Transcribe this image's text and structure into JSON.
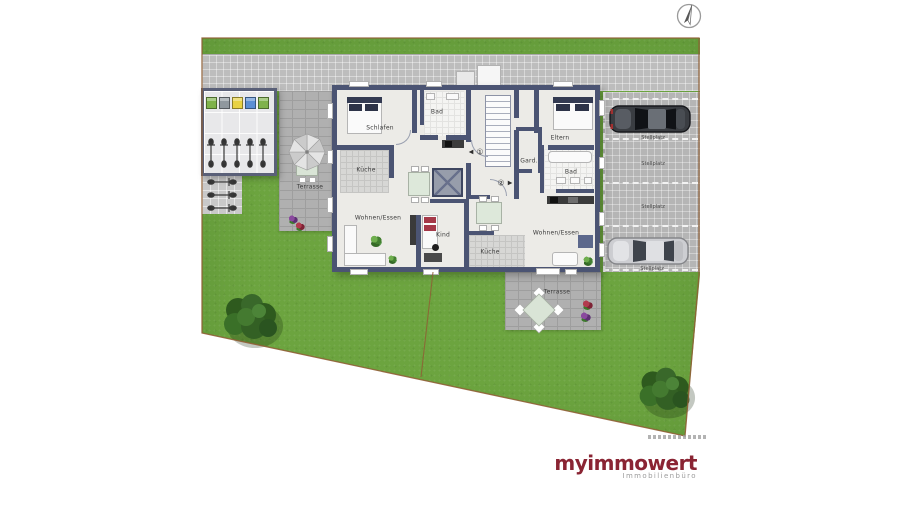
{
  "site_plan": {
    "compass_icon": "north-arrow",
    "apartments": {
      "unit1": {
        "number_symbol": "①",
        "door_marker": "◀",
        "rooms": {
          "bedroom": "Schlafen",
          "bath": "Bad",
          "kitchen": "Küche",
          "living_dining": "Wohnen/Essen",
          "child": "Kind"
        }
      },
      "unit2": {
        "number_symbol": "②",
        "door_marker": "▶",
        "rooms": {
          "parents": "Eltern",
          "wardrobe": "Gard.",
          "bath": "Bad",
          "living_dining": "Wohnen/Essen",
          "kitchen": "Küche"
        }
      }
    },
    "outdoor": {
      "terrace_left_label": "Terrasse",
      "terrace_bottom_label": "Terrasse",
      "parking_spaces": [
        "Stellplatz",
        "Stellplatz",
        "Stellplatz",
        "Stellplatz"
      ]
    }
  },
  "branding": {
    "logo_text": "myimmowert",
    "tagline": "Immobilienbüro"
  },
  "colors": {
    "brand": "#8A2433",
    "tagline": "#9C9C9C",
    "grass": "#6CA43F",
    "wall": "#4B5473",
    "road": "#BDBDBD",
    "floor": "#ECEBE7",
    "boundary": "#8F5F35"
  }
}
